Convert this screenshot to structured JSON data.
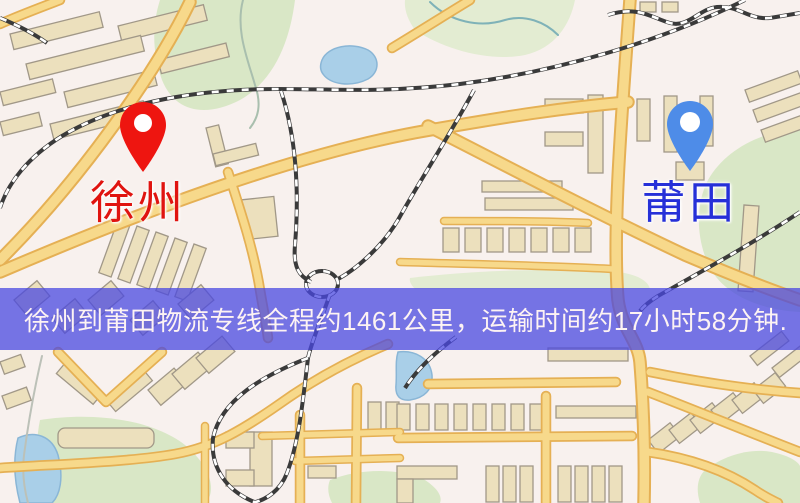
{
  "banner": {
    "text": "徐州到莆田物流专线全程约1461公里，运输时间约17小时58分钟.",
    "distance": "1461公里",
    "duration": "17小时58分钟"
  },
  "markers": {
    "origin": {
      "label": "徐州"
    },
    "destination": {
      "label": "莆田"
    }
  },
  "theme": {
    "map-bg": "#f8f1ee",
    "park": "#d9e7c6",
    "park-lite": "#e3ecd2",
    "water": "#a9cfe8",
    "water-edge": "#8ab6d6",
    "river": "#a9bfae",
    "road-fill": "#f7d98b",
    "road-casing": "#e5b054",
    "building-fill": "#ece0bd",
    "building-stroke": "#a19888",
    "railway": "#3a3a3a",
    "banner-bg": "rgba(74,72,224,0.75)",
    "banner-text": "#fdf3f3",
    "origin-pin": "#ee1510",
    "origin-label": "#e01410",
    "dest-pin": "#4e8ce8",
    "dest-label": "#2630d8"
  }
}
